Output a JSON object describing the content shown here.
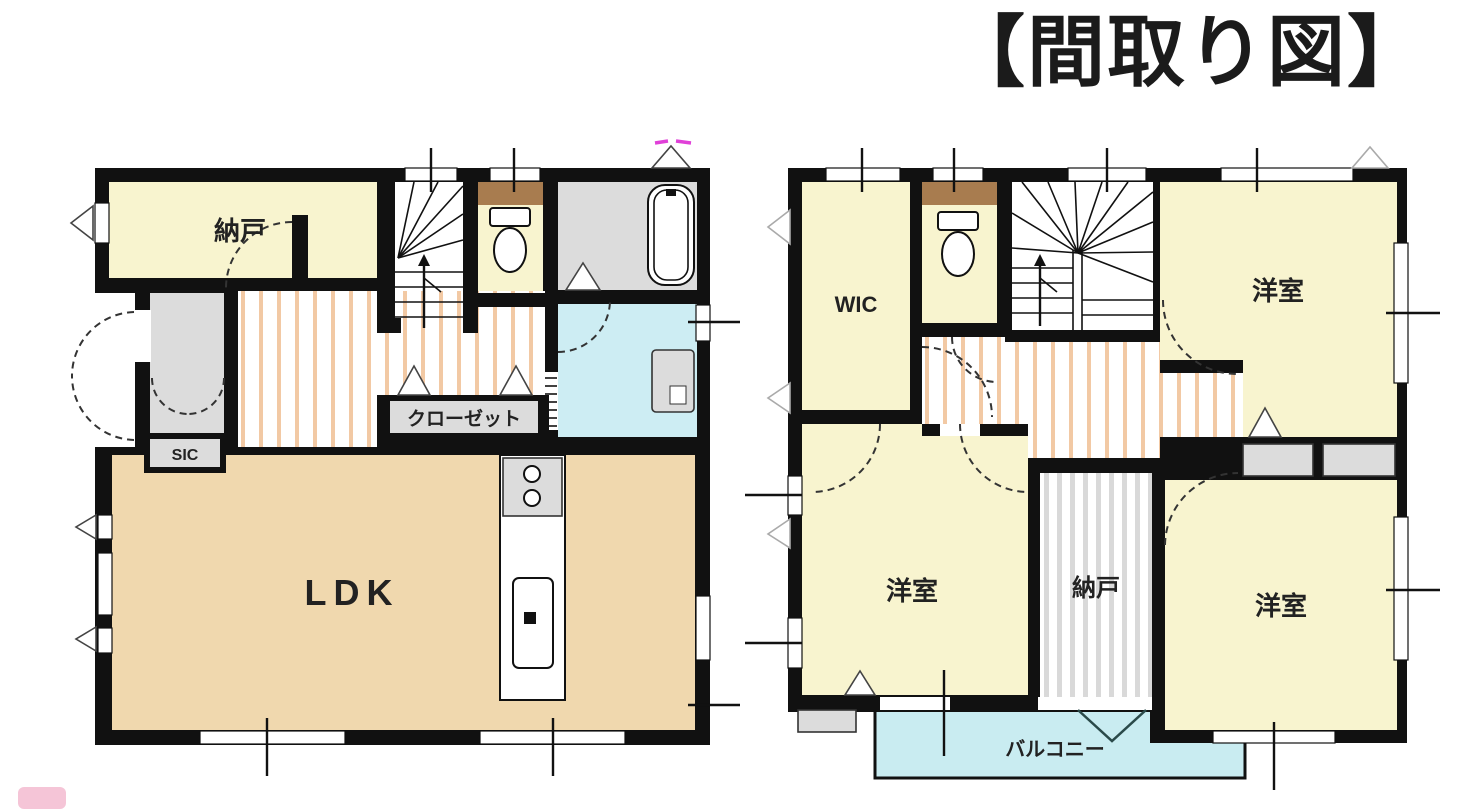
{
  "title": "【間取り図】",
  "floor1": {
    "rooms": {
      "storage": "納戸",
      "ldk": "LDK",
      "shoe_closet": "SIC",
      "closet": "クローゼット"
    }
  },
  "floor2": {
    "rooms": {
      "walk_in_closet": "WIC",
      "bedroom_top_right": "洋室",
      "bedroom_bottom_left": "洋室",
      "bedroom_bottom_right": "洋室",
      "storage": "納戸",
      "balcony": "バルコニー"
    }
  },
  "colors": {
    "wall": "#111111",
    "room_cream": "#f8f4cf",
    "ldk_tan": "#f0d8ae",
    "wet_area_gray": "#dcdcdc",
    "washroom_blue": "#cdedf3",
    "balcony_blue": "#c9ecf1",
    "counter_brown": "#a87c4f",
    "floor_stripe_orange": "#f2c9a4",
    "storage_stripe_gray": "#d9d9d9",
    "vent_mark_magenta": "#e040d8",
    "title_black": "#1b1b1b",
    "watermark_pink": "#f3bbd0"
  }
}
